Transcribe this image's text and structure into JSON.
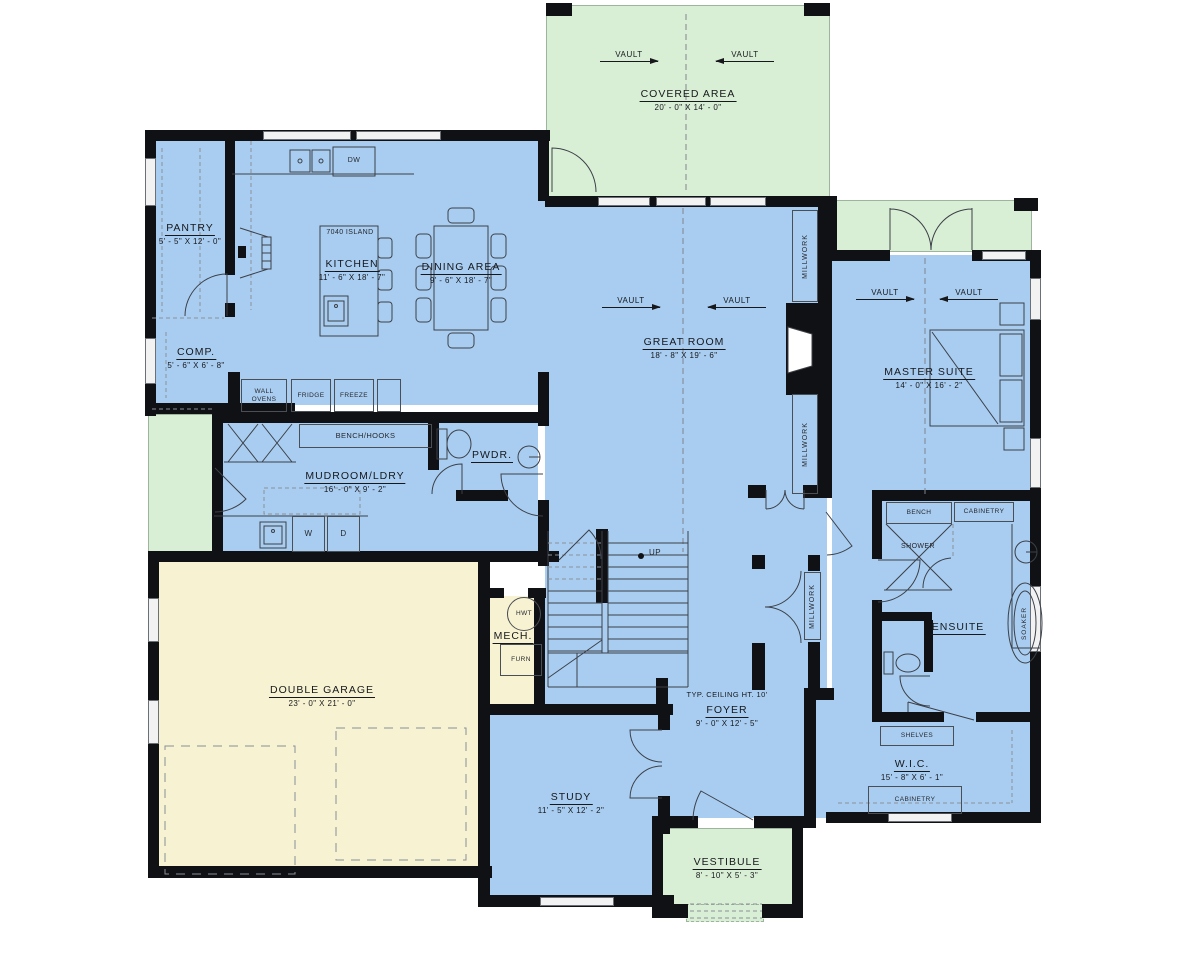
{
  "colors": {
    "room_blue": "#a9cdf1",
    "area_green": "#d9efd5",
    "garage_yellow": "#f7f3d2",
    "wall_black": "#101114",
    "line": "#3c4048",
    "window_fill": "#f2f2f2"
  },
  "rooms": {
    "covered_area": {
      "name": "COVERED AREA",
      "dims": "20' - 0\" X 14' - 0\""
    },
    "pantry": {
      "name": "PANTRY",
      "dims": "5' - 5\" X 12' - 0\""
    },
    "kitchen": {
      "name": "KITCHEN",
      "dims": "11' - 6\" X 18' - 7\""
    },
    "dining": {
      "name": "DINING AREA",
      "dims": "9' - 6\" X 18' - 7\""
    },
    "comp": {
      "name": "COMP.",
      "dims": "5' - 6\" X 6' - 8\""
    },
    "great_room": {
      "name": "GREAT ROOM",
      "dims": "18' - 8\" X 19' - 6\""
    },
    "master_suite": {
      "name": "MASTER SUITE",
      "dims": "14' - 0\" X 16' - 2\""
    },
    "mudroom": {
      "name": "MUDROOM/LDRY",
      "dims": "16' - 0\" X 9' - 2\""
    },
    "pwdr": {
      "name": "PWDR."
    },
    "mech": {
      "name": "MECH."
    },
    "garage": {
      "name": "DOUBLE GARAGE",
      "dims": "23' - 0\" X 21' - 0\""
    },
    "study": {
      "name": "STUDY",
      "dims": "11' - 5\" X 12' - 2\""
    },
    "foyer": {
      "name": "FOYER",
      "dims": "9' - 0\" X 12' - 5\"",
      "note": "TYP. CEILING HT. 10'"
    },
    "vestibule": {
      "name": "VESTIBULE",
      "dims": "8' - 10\" X 5' - 3\""
    },
    "ensuite": {
      "name": "ENSUITE"
    },
    "wic": {
      "name": "W.I.C.",
      "dims": "15' - 8\" X 6' - 1\""
    }
  },
  "fixtures": {
    "island": "7040 ISLAND",
    "dw": "DW",
    "wall_ovens": "WALL OVENS",
    "fridge": "FRIDGE",
    "freeze": "FREEZE",
    "bench_hooks": "BENCH/HOOKS",
    "washer": "W",
    "dryer": "D",
    "hwt": "HWT",
    "furn": "FURN",
    "up": "UP",
    "bench": "BENCH",
    "cabinetry": "CABINETRY",
    "shower": "SHOWER",
    "soaker": "SOAKER",
    "shelves": "SHELVES",
    "millwork": "MILLWORK",
    "vault": "VAULT"
  }
}
